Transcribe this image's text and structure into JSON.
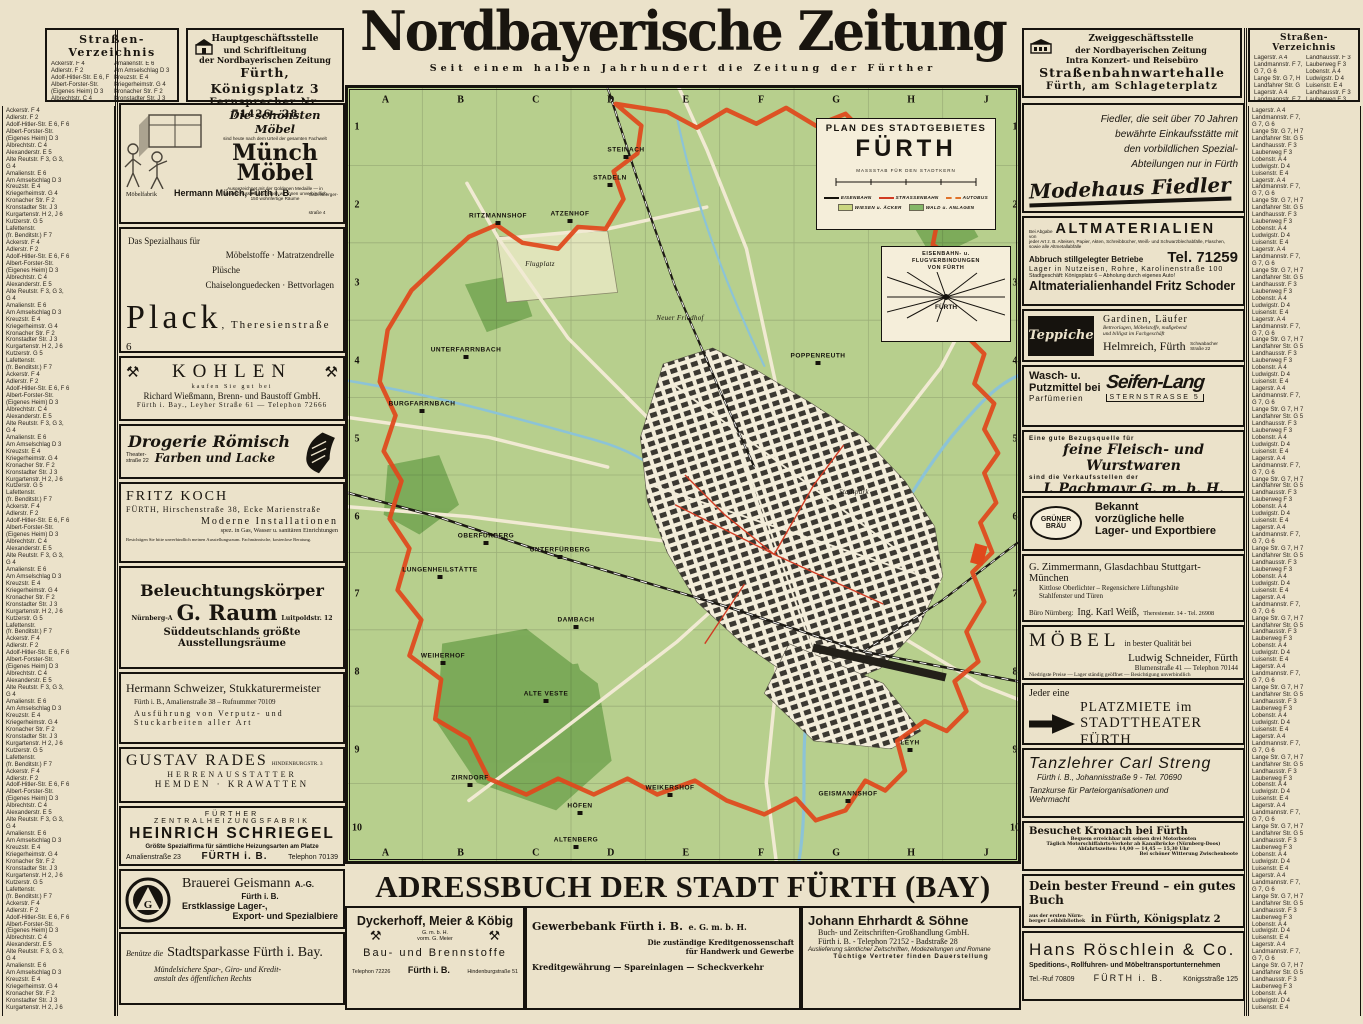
{
  "colors": {
    "paper": "#ebe2ca",
    "meadow": "#b7cf8d",
    "forest": "#79a957",
    "water": "#8cc3d6",
    "boundary": "#e0481c",
    "tram": "#d13b22",
    "bus": "#e0722a",
    "ink": "#19150f"
  },
  "icons": {
    "crossed-hammers": "⚒",
    "building": "⌂",
    "separator-dot": "·"
  },
  "masthead": {
    "title": "Nordbayerische Zeitung",
    "subtitle": "Seit einem halben Jahrhundert die Zeitung der Fürther"
  },
  "head_office": {
    "line1": "Hauptgeschäftsstelle",
    "line2": "und Schriftleitung",
    "line3": "der Nordbayerischen Zeitung",
    "line4": "Fürth, Königsplatz 3",
    "line5": "Fernsprecher Nr. 71426—28"
  },
  "branch_office": {
    "line1": "Zweiggeschäftsstelle",
    "line2": "der Nordbayerischen Zeitung",
    "line3": "Intra Konzert- und Reisebüro",
    "line4": "Straßenbahnwartehalle",
    "line5": "Fürth, am Schlageterplatz"
  },
  "street_index": {
    "title": "Straßen-Verzeichnis",
    "left_entries": [
      "Ackerstr.  F 4",
      "Adlerstr.  F 2",
      "Adolf-Hitler-Str.  E 6, F 6",
      "Albert-Forster-Str.",
      "(Eigenes Heim)  D 3",
      "Albrechtstr.  C 4",
      "Alexanderstr.  E 5",
      "Alte Reutstr.  F 3, G 3,",
      "G 4",
      "Amalienstr.  E 6",
      "Am Amselschlag  D 3",
      "Kreuzstr.  E 4",
      "Kriegerheimstr.  G 4",
      "Kronacher Str.  F 2",
      "Kronstadter Str.  J 3",
      "Kurgartenstr.  H 2, J 6",
      "Kutzerstr.  G 5",
      "Lafettenstr.",
      "(fr. Benditstr.)  F 7"
    ],
    "right_entries": [
      "Lagerstr.  A 4",
      "Landmannstr.  F 7,",
      "G 7, G 6",
      "Lange Str.  G 7, H 7",
      "Landfahrer Str.  G 5",
      "Landhausstr.  F 3",
      "Lauberweg  F 3",
      "Lobenstr.  A 4",
      "Ludwigstr.  D 4",
      "Luisenstr.  E 4"
    ]
  },
  "map": {
    "title_line1": "PLAN DES STADTGEBIETES",
    "title_line2": "FÜRTH",
    "scale_label": "MASSSTAB FÜR DEN STADTKERN",
    "legend": {
      "rail": "EISENBAHN",
      "tram": "STRASSENBAHN",
      "bus": "AUTOBUS",
      "meadow": "WIESEN u. ÄCKER",
      "forest": "WALD u. ANLAGEN"
    },
    "inset": {
      "line1": "EISENBAHN- u.",
      "line2": "FLUGVERBINDUNGEN",
      "line3": "VON FÜRTH",
      "center": "FÜRTH"
    },
    "grid_cols": [
      "A",
      "B",
      "C",
      "D",
      "E",
      "F",
      "G",
      "H",
      "J"
    ],
    "grid_rows": [
      "1",
      "2",
      "3",
      "4",
      "5",
      "6",
      "7",
      "8",
      "9",
      "10"
    ],
    "places": [
      {
        "label": "STEINACH",
        "x": 278,
        "y": 62,
        "kind": "village"
      },
      {
        "label": "STADELN",
        "x": 262,
        "y": 90,
        "kind": "village"
      },
      {
        "label": "RITZMANNSHOF",
        "x": 150,
        "y": 128,
        "kind": "village"
      },
      {
        "label": "ATZENHOF",
        "x": 222,
        "y": 126,
        "kind": "village"
      },
      {
        "label": "Flugplatz",
        "x": 192,
        "y": 176,
        "kind": "area"
      },
      {
        "label": "Neuer Friedhof",
        "x": 332,
        "y": 230,
        "kind": "area"
      },
      {
        "label": "UNTERFARRNBACH",
        "x": 118,
        "y": 262,
        "kind": "village"
      },
      {
        "label": "POPPENREUTH",
        "x": 470,
        "y": 268,
        "kind": "village"
      },
      {
        "label": "BURGFARRNBACH",
        "x": 74,
        "y": 316,
        "kind": "village"
      },
      {
        "label": "OBERFÜRBERG",
        "x": 138,
        "y": 448,
        "kind": "village"
      },
      {
        "label": "UNTERFÜRBERG",
        "x": 212,
        "y": 462,
        "kind": "village"
      },
      {
        "label": "LUNGENHEILSTÄTTE",
        "x": 92,
        "y": 482,
        "kind": "village"
      },
      {
        "label": "Stadtpark",
        "x": 506,
        "y": 404,
        "kind": "area"
      },
      {
        "label": "DAMBACH",
        "x": 228,
        "y": 532,
        "kind": "village"
      },
      {
        "label": "WEIHERHOF",
        "x": 95,
        "y": 568,
        "kind": "village"
      },
      {
        "label": "ALTE VESTE",
        "x": 198,
        "y": 606,
        "kind": "village"
      },
      {
        "label": "ZIRNDORF",
        "x": 122,
        "y": 690,
        "kind": "village"
      },
      {
        "label": "HÖFEN",
        "x": 232,
        "y": 718,
        "kind": "village"
      },
      {
        "label": "WEIKERSHOF",
        "x": 322,
        "y": 700,
        "kind": "village"
      },
      {
        "label": "GEISMANNSHOF",
        "x": 500,
        "y": 706,
        "kind": "village"
      },
      {
        "label": "ALTENBERG",
        "x": 228,
        "y": 752,
        "kind": "village"
      },
      {
        "label": "LEYH",
        "x": 562,
        "y": 655,
        "kind": "village"
      }
    ]
  },
  "adressbuch_title": "ADRESSBUCH DER STADT FÜRTH (BAY)",
  "ads": {
    "muench": {
      "tagline": "Die schönsten Möbel",
      "tagline2": "sind heute nach dem Urteil der gesamten Fachwelt",
      "brand1": "Münch",
      "brand2": "Möbel",
      "note1": "Ausgezeichnet mit der Goldenen Medaille — in",
      "note2": "unserer Ausstellung zeigen wir Ihnen unverbindlich",
      "note3": "150 wohnfertige Räume",
      "footer1": "Möbelfabrik",
      "footer2": "Hermann Münch, Fürth i. B.",
      "footer3a": "Gabelsberger-",
      "footer3b": "straße 4"
    },
    "plack": {
      "intro": "Das Spezialhaus für",
      "item1": "Möbelstoffe · Matratzendrelle",
      "item2": "Plüsche",
      "item3": "Chaiselonguedecken · Bettvorlagen",
      "name": "Plack",
      "addr": ", Theresienstraße 6"
    },
    "kohlen": {
      "title": "KOHLEN",
      "sub": "kaufen Sie gut bei",
      "line1": "Richard Wießmann, Brenn- und Baustoff GmbH.",
      "line2": "Fürth i. Bay., Leyher Straße 61 — Telephon 72666"
    },
    "roemisch": {
      "name": "Drogerie Römisch",
      "addr1": "Theater-",
      "addr2": "straße 22",
      "line": "Farben und Lacke"
    },
    "koch": {
      "name": "FRITZ KOCH",
      "line1": "FÜRTH, Hirschenstraße 38, Ecke Marienstraße",
      "line2": "Moderne Installationen",
      "line3": "spez. in Gas, Wasser u. sanitären Einrichtungen",
      "line4": "Besichtigen Sie bitte unverbindlich meinen Ausstellungsraum. Fachmännische, kostenlose Beratung."
    },
    "raum": {
      "title": "Beleuchtungskörper",
      "city": "Nürnberg-A",
      "name": "G. Raum",
      "addr": "Luitpoldstr. 12",
      "line1": "Süddeutschlands größte",
      "line2": "Ausstellungsräume"
    },
    "schweizer": {
      "name": "Hermann Schweizer, Stukkaturermeister",
      "line1": "Fürth i. B., Amalienstraße 38 – Rufnummer 70109",
      "line2": "Ausführung von Verputz- und",
      "line3": "Stuckarbeiten aller Art"
    },
    "rades": {
      "name": "GUSTAV RADES",
      "addr": "HINDENBURGSTR. 3",
      "line1": "HERRENAUSSTATTER",
      "line2": "HEMDEN · KRAWATTEN"
    },
    "schriegel": {
      "over": "FÜRTHER ZENTRALHEIZUNGSFABRIK",
      "name": "HEINRICH SCHRIEGEL",
      "line": "Größte Spezialfirma für sämtliche Heizungsarten am Platze",
      "addr": "Amalienstraße 23",
      "city": "FÜRTH i. B.",
      "tel": "Telephon 70139"
    },
    "geismann": {
      "name": "Brauerei Geismann",
      "suffix": "A.-G.",
      "city": "Fürth i. B.",
      "line1": "Erstklassige Lager-,",
      "line2": "Export- und Spezialbiere"
    },
    "sparkasse": {
      "pre": "Benütze die",
      "name": "Stadtsparkasse Fürth i. Bay.",
      "line1": "Mündelsichere Spar-, Giro- und Kredit-",
      "line2": "anstalt des öffentlichen Rechts"
    },
    "fiedler": {
      "line1": "Fiedler, die seit über 70 Jahren",
      "line2": "bewährte Einkaufsstätte mit",
      "line3": "den vorbildlichen Spezial-",
      "line4": "Abteilungen nur in Fürth",
      "brand": "Modehaus Fiedler"
    },
    "schoder": {
      "pre1": "Bei Abgabe",
      "pre2": "von",
      "title": "ALTMATERIALIEN",
      "small1": "jeder Art z. B. Alteisen, Papier, Akten, Schreibbücher, Weiß- und Schwarzblechabfälle, Flaschen, sowie alle Altmetallabfälle",
      "bold1": "Abbruch stillgelegter Betriebe",
      "tel": "Tel. 71259",
      "line1": "Lager in Nutzeisen, Rohre, Karolinenstraße 100",
      "line2": "Stadtgeschäft: Königsplatz 6 – Abholung durch eigenes Auto!",
      "name": "Altmaterialienhandel Fritz Schoder"
    },
    "helmreich": {
      "img": "Teppiche",
      "line1": "Gardinen, Läufer",
      "line2": "Bettvorlagen, Möbelstoffe, maßgebend",
      "line3": "und billigst im Fachgeschäft",
      "name": "Helmreich, Fürth",
      "addr1": "Schwabacher",
      "addr2": "Straße 22"
    },
    "seifenlang": {
      "line1": "Wasch- u.",
      "line2": "Putzmittel bei",
      "line3": "Parfümerien",
      "brand": "Seifen-Lang",
      "addr": "STERNSTRASSE 5"
    },
    "pachmayr": {
      "pre": "Eine gute Bezugsquelle für",
      "main": "feine Fleisch- und Wurstwaren",
      "mid": "sind die Verkaufsstellen der",
      "name": "J. Pachmayr G. m. b. H.",
      "addr": "am Kohlenmarkt – Karolinenstraße 104"
    },
    "gruener": {
      "logo1": "GRÜNER",
      "logo2": "BRÄU",
      "line1": "Bekannt",
      "line2": "vorzügliche helle",
      "line3": "Lager- und Exportbiere"
    },
    "zimmermann": {
      "name": "G. Zimmermann, Glasdachbau Stuttgart-München",
      "line1": "Kittlose Oberlichter – Regensichere Lüftungshüte",
      "line2": "Stahlfenster und Türen",
      "line3": "Büro Nürnberg:",
      "name2": "Ing. Karl Weiß,",
      "line4": "Theresienstr. 14 - Tel. 26908"
    },
    "schneider": {
      "big": "MÖBEL",
      "line1": "in bester Qualität bei",
      "name": "Ludwig Schneider, Fürth",
      "line2": "Blumenstraße 41 — Telephon 70144",
      "line3": "Niedrigste Preise — Lager ständig geöffnet — Besichtigung unverbindlich"
    },
    "platzmiete": {
      "pre": "Jeder eine",
      "line1": "PLATZMIETE im",
      "line2": "STADTTHEATER FÜRTH"
    },
    "streng": {
      "name": "Tanzlehrer Carl Streng",
      "line1": "Fürth i. B., Johannisstraße 9 - Tel. 70690",
      "line2": "Tanzkurse für Parteiorganisationen und",
      "line3": "Wehrmacht"
    },
    "kronach": {
      "title": "Besuchet Kronach bei Fürth",
      "line1": "Bequem erreichbar mit seinen drei Motorbooten",
      "line2": "Täglich Motorschiffahrts-Verkehr ab Kanalbrücke (Nürnberg-Doos)",
      "line3": "Abfahrtszeiten: 14,00 — 14,45 — 15,30 Uhr",
      "line4": "Bei schöner Witterung Zwischenboote"
    },
    "proels": {
      "title": "Dein bester Freund – ein gutes Buch",
      "small1": "aus der ersten Nürn-",
      "small2": "berger Leihbibliothek",
      "line": "in Fürth, Königsplatz 2",
      "foot": "laufende Anschaffung sämtlicher Neuheiten",
      "sig": "A. M. Prölß"
    },
    "roeschlein": {
      "name": "Hans Röschlein & Co.",
      "line": "Speditions-, Rollfuhren- und Möbeltransportunternehmen",
      "tel": "Tel.-Ruf 70809",
      "city": "FÜRTH i. B.",
      "addr": "Königsstraße 125"
    },
    "dyckerhoff": {
      "name": "Dyckerhoff, Meier & Köbig",
      "sub1": "G. m. b. H.",
      "sub2": "vorm. G. Meier",
      "line": "Bau- und Brennstoffe",
      "tel": "Telephon 72226",
      "city": "Fürth i. B.",
      "addr": "Hindenburgstraße 51"
    },
    "gewerbebank": {
      "name": "Gewerbebank Fürth i. B.",
      "suffix": "e. G. m. b. H.",
      "line1": "Die zuständige Kreditgenossenschaft",
      "line2": "für Handwerk und Gewerbe",
      "line3": "Kreditgewährung — Spareinlagen — Scheckverkehr"
    },
    "ehrhardt": {
      "name": "Johann Ehrhardt & Söhne",
      "line1": "Buch- und Zeitschriften-Großhandlung GmbH.",
      "line2": "Fürth i. B. - Telephon 72152 - Badstraße 28",
      "line3": "Auslieferung sämtlicher Zeitschriften, Modezeitungen und Romane",
      "line4": "Tüchtige Vertreter finden Dauerstellung"
    }
  }
}
